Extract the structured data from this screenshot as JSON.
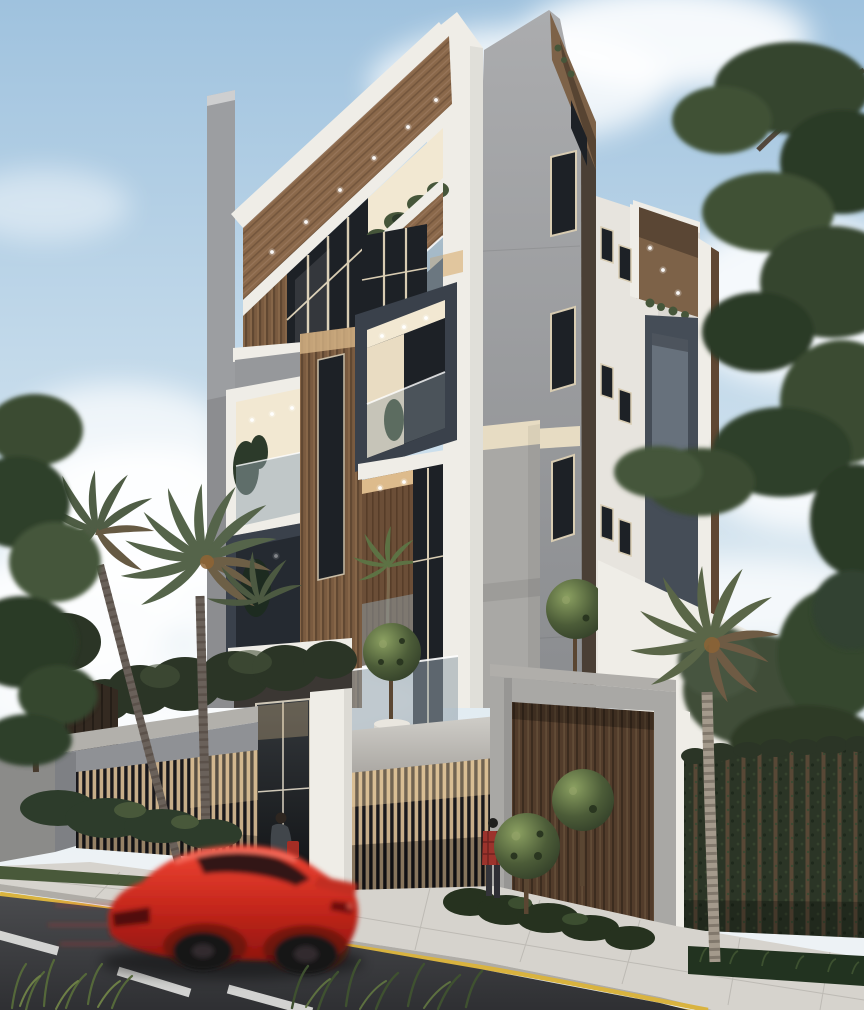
{
  "scene": {
    "title": "Architectural rendering of a modern multi-storey apartment building on a street corner",
    "time_of_day": "daytime, partly cloudy sky",
    "building": {
      "style": "contemporary",
      "storeys_visible": 5,
      "materials": [
        "white plaster",
        "grey concrete",
        "charcoal metal panel",
        "wood slats",
        "glass"
      ],
      "features": [
        "deep white picture-frame balconies",
        "charcoal box balconies",
        "recessed lit ceilings with spotlights",
        "balcony shrubs and palm plants",
        "glass balustrades",
        "wood slat garage screen",
        "large wood entry gate"
      ]
    },
    "street_level": {
      "perimeter_wall": "grey concrete frame with vertical timber slats",
      "entrance": "glass door with white pillar and dark canopy",
      "gate": "dark timber plank gate in concrete frame",
      "right_fence": "green hedge wall with timber posts",
      "sidewalk": "light paver sidewalk with planting strip",
      "road_markings": [
        "yellow double edge line",
        "white dashed centre line"
      ]
    },
    "vehicle": {
      "type": "sports coupe",
      "color_name": "red",
      "state": "motion-blurred, driving past"
    },
    "people": [
      {
        "id": "person-1",
        "description": "person with dark jacket, blue jeans and red bag at the glass entrance"
      },
      {
        "id": "person-2",
        "description": "person in red plaid shirt standing near the gate"
      }
    ],
    "vegetation": [
      "two tall palm trees at left",
      "palm tree at right",
      "pine tree upper right",
      "pine branches at far left",
      "ball topiary trees",
      "hedges and shrubs",
      "grass tufts in foreground"
    ]
  },
  "palette": {
    "sky": "#a5c6e0",
    "sky_low": "#e9f0f4",
    "cloud": "#ffffff",
    "wall_white": "#efede7",
    "wall_white_shade": "#e7e4de",
    "concrete": "#9a9b9e",
    "concrete_light": "#a9a8a5",
    "concrete_mid": "#96989b",
    "concrete_dark": "#7e8084",
    "charcoal": "#454d57",
    "charcoal_frame": "#3a414b",
    "wood": "#7d6248",
    "wood_dark": "#5f4733",
    "cream": "#e7dcc3",
    "cream_lit": "#f2e8d2",
    "warm_light": "#ddbb8c",
    "glass_dark": "#1d2126",
    "glass_pane": "#92a1a9",
    "mullion": "#d8ccb2",
    "shrub": "#46563a",
    "shrub_dark": "#2c3a2a",
    "hedge": "#2b3526",
    "foliage_pine": "#344430",
    "palm_frond": "#55644a",
    "palm_dead_frond": "#6d5f46",
    "trunk": "#8c8173",
    "sidewalk": "#d6d3cd",
    "curb_yellow": "#d9b33f",
    "lane_white": "#e4e4e2",
    "road": "#3b3c3f",
    "grass": "#55683a",
    "car_red": "#d8281c",
    "car_red_dark": "#8e140e",
    "denim": "#5d7189",
    "bag_red": "#a32d24",
    "plaid_red": "#9c332c"
  }
}
